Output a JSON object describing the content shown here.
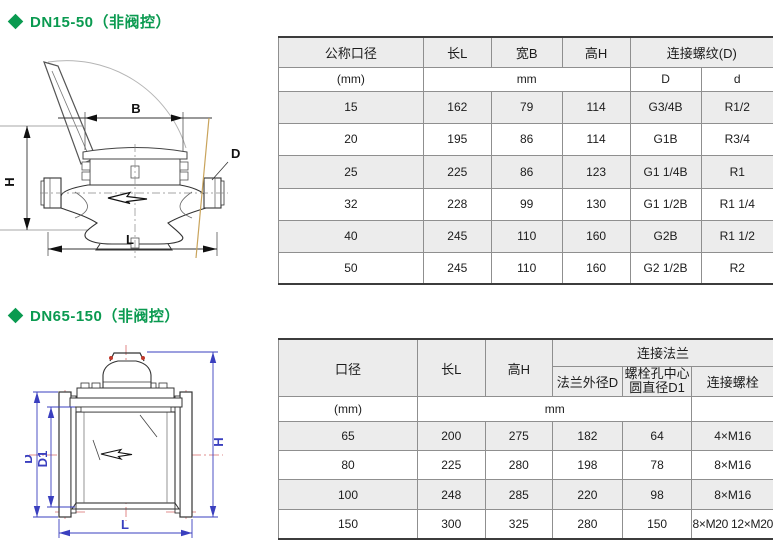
{
  "colors": {
    "accent_green": "#0a9a50",
    "table_shade": "#ececec",
    "dim_blue": "#3a3fbf",
    "centerline_red": "#d96a6a",
    "tan_line": "#c9a45c"
  },
  "section1": {
    "title": "DN15-50（非阀控）",
    "drawing": {
      "labels": {
        "B": "B",
        "H": "H",
        "L": "L",
        "D": "D"
      }
    },
    "table": {
      "headers": {
        "dn": "公称口径",
        "length": "长L",
        "width": "宽B",
        "height": "高H",
        "thread": "连接螺纹(D)",
        "unit_dn": "(mm)",
        "unit_dims": "mm",
        "thread_d": "D",
        "thread_d_small": "d"
      },
      "rows": [
        [
          "15",
          "162",
          "79",
          "114",
          "G3/4B",
          "R1/2"
        ],
        [
          "20",
          "195",
          "86",
          "114",
          "G1B",
          "R3/4"
        ],
        [
          "25",
          "225",
          "86",
          "123",
          "G1 1/4B",
          "R1"
        ],
        [
          "32",
          "228",
          "99",
          "130",
          "G1 1/2B",
          "R1 1/4"
        ],
        [
          "40",
          "245",
          "110",
          "160",
          "G2B",
          "R1 1/2"
        ],
        [
          "50",
          "245",
          "110",
          "160",
          "G2 1/2B",
          "R2"
        ]
      ]
    }
  },
  "section2": {
    "title": "DN65-150（非阀控）",
    "drawing": {
      "labels": {
        "D": "D",
        "D1": "D1",
        "H": "H",
        "L": "L"
      }
    },
    "table": {
      "headers": {
        "dn": "口径",
        "length": "长L",
        "height": "高H",
        "flange": "连接法兰",
        "flange_od": "法兰外径D",
        "bolt_circle_line1": "螺栓孔中心",
        "bolt_circle_line2": "圆直径D1",
        "bolts": "连接螺栓",
        "unit_dn": "(mm)",
        "unit_dims": "mm",
        "unit_blank": ""
      },
      "rows": [
        [
          "65",
          "200",
          "275",
          "182",
          "64",
          "4×M16"
        ],
        [
          "80",
          "225",
          "280",
          "198",
          "78",
          "8×M16"
        ],
        [
          "100",
          "248",
          "285",
          "220",
          "98",
          "8×M16"
        ],
        [
          "150",
          "300",
          "325",
          "280",
          "150",
          "8×M20 12×M20"
        ]
      ]
    }
  }
}
